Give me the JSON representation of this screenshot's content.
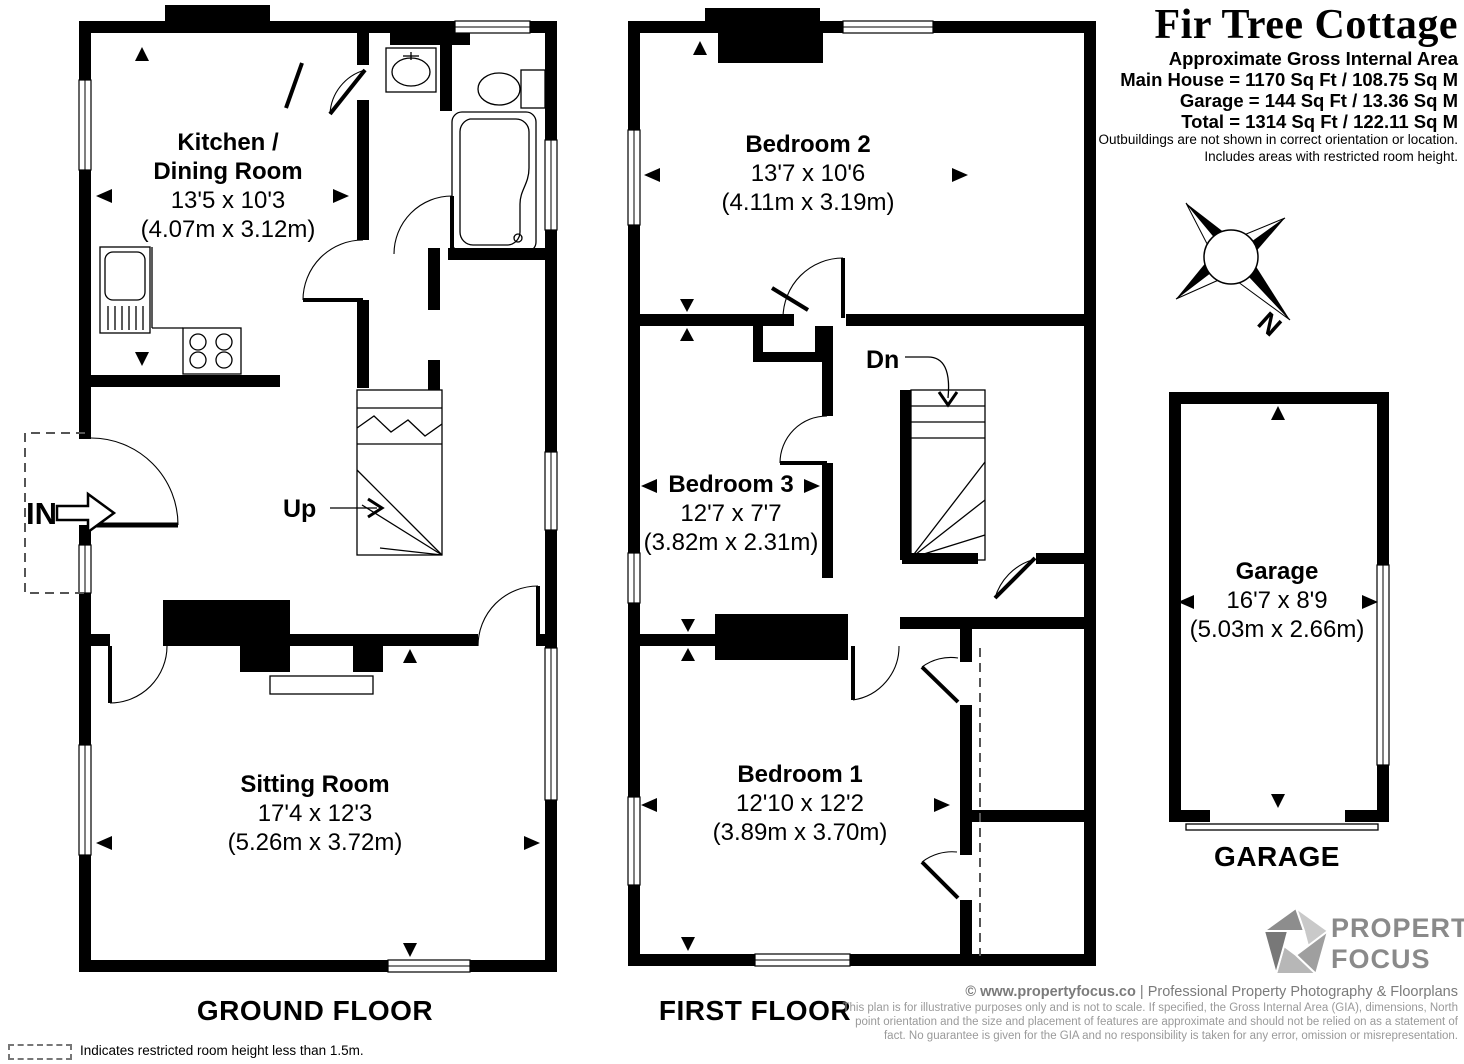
{
  "title_block": {
    "title": "Fir Tree Cottage",
    "subtitle": "Approximate Gross Internal Area",
    "area_lines": [
      "Main House = 1170 Sq Ft / 108.75 Sq M",
      "Garage = 144 Sq Ft / 13.36 Sq M",
      "Total = 1314 Sq Ft / 122.11 Sq M"
    ],
    "notes": [
      "Outbuildings are not shown in correct orientation or location.",
      "Includes areas with restricted room height."
    ]
  },
  "floors": {
    "ground": {
      "label": "GROUND FLOOR",
      "kitchen": {
        "name1": "Kitchen /",
        "name2": "Dining Room",
        "imperial": "13'5 x 10'3",
        "metric": "(4.07m x 3.12m)"
      },
      "sitting": {
        "name": "Sitting Room",
        "imperial": "17'4 x 12'3",
        "metric": "(5.26m x 3.72m)"
      },
      "entrance": "IN",
      "stairs_up": "Up"
    },
    "first": {
      "label": "FIRST FLOOR",
      "bedroom2": {
        "name": "Bedroom 2",
        "imperial": "13'7 x 10'6",
        "metric": "(4.11m x 3.19m)"
      },
      "bedroom3": {
        "name": "Bedroom 3",
        "imperial": "12'7 x 7'7",
        "metric": "(3.82m x 2.31m)"
      },
      "bedroom1": {
        "name": "Bedroom 1",
        "imperial": "12'10 x 12'2",
        "metric": "(3.89m x 3.70m)"
      },
      "stairs_down": "Dn"
    },
    "garage": {
      "label": "GARAGE",
      "room": {
        "name": "Garage",
        "imperial": "16'7 x 8'9",
        "metric": "(5.03m x 2.66m)"
      }
    }
  },
  "compass": {
    "north": "N"
  },
  "legend": {
    "restricted": "Indicates restricted room height less than 1.5m."
  },
  "footer": {
    "copyright": "© www.propertyfocus.co",
    "separator": "|",
    "tagline": "Professional Property Photography & Floorplans",
    "disclaimer": [
      "This plan is for illustrative purposes only and is not to scale. If specified, the Gross Internal Area (GIA), dimensions, North",
      "point orientation and the size and placement of features are approximate and should not be relied on as a statement of",
      "fact. No guarantee is given for the GIA and no responsibility is taken for any error, omission or misrepresentation."
    ]
  },
  "logo": {
    "name1": "PROPERTY",
    "name2": "FOCUS"
  },
  "colors": {
    "walls": "#000000",
    "logo_text": "#8a8a8a",
    "logo_pentagon": [
      "#c9c9c9",
      "#9f9f9f",
      "#b7b7b7",
      "#8d8d8d",
      "#787878"
    ],
    "footer_text": "#7b7b7b",
    "disclaimer_text": "#9a9a9a"
  }
}
